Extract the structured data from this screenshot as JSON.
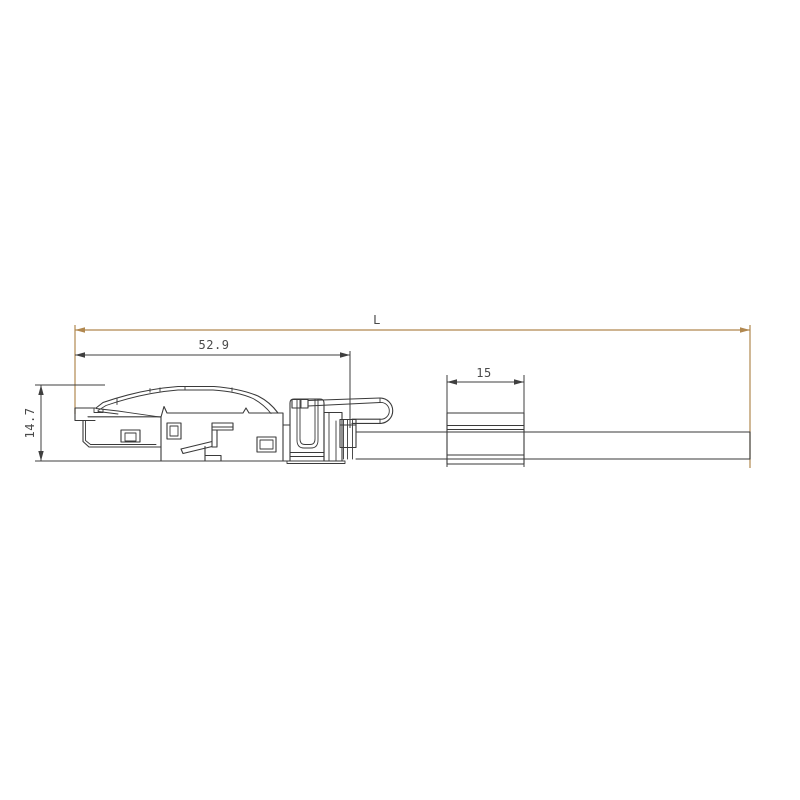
{
  "drawing": {
    "type": "technical-dimension-drawing",
    "subject": "rj45-connector-with-cable-side-view",
    "labels": {
      "overall_length": "L",
      "connector_length": "52.9",
      "connector_height": "14.7",
      "sleeve_length": "15"
    },
    "colors": {
      "background": "#ffffff",
      "drawing_line": "#3a3a3a",
      "dimension_line": "#3f3f3f",
      "accent_dimension_line": "#b1884f",
      "dimension_text": "#4a4a4a"
    }
  }
}
